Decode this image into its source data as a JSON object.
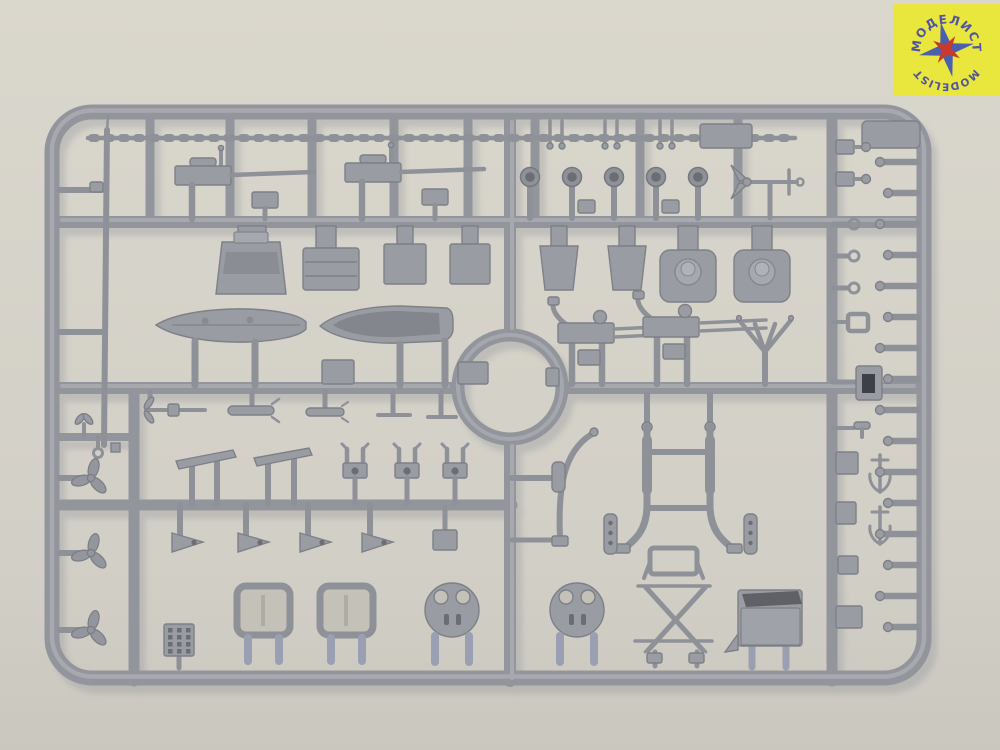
{
  "scene": {
    "description": "Photograph of a grey injection-moulded plastic model-kit sprue (parts runner) with naval ship fittings, lying on a light warm-grey background",
    "colors": {
      "background_top": "#dad7cd",
      "background_bottom": "#cac7bf",
      "plastic_base": "#93959c",
      "plastic_highlight": "#b2b4ba",
      "plastic_shadow": "#7e8087",
      "plastic_blue_tint": "#9aa0b2",
      "recess_dark": "#6b6d73"
    }
  },
  "logo": {
    "text_top": "МОДЕЛИСТ",
    "text_bottom": "MODELIST",
    "colors": {
      "background": "#e9e63d",
      "text": "#5054a4",
      "star_outer": "#4a5fae",
      "star_inner": "#c8392f"
    }
  },
  "sprue": {
    "parts": [
      {
        "label": "signal mast pole",
        "count": 1
      },
      {
        "label": "deck railing strip",
        "count": 1
      },
      {
        "label": "deck gun",
        "count": 2
      },
      {
        "label": "mooring bollard pair",
        "count": 3
      },
      {
        "label": "equipment block",
        "count": 1
      },
      {
        "label": "searchlight",
        "count": 5
      },
      {
        "label": "stocked anchor",
        "count": 1
      },
      {
        "label": "gun house",
        "count": 1
      },
      {
        "label": "stowage box",
        "count": 1
      },
      {
        "label": "deck cabin",
        "count": 2
      },
      {
        "label": "hopper box",
        "count": 2
      },
      {
        "label": "turret base with barbette",
        "count": 2
      },
      {
        "label": "ship's boat with deck",
        "count": 1
      },
      {
        "label": "open ship's boat",
        "count": 1
      },
      {
        "label": "small deckhouse",
        "count": 2
      },
      {
        "label": "circular runner ring",
        "count": 1
      },
      {
        "label": "twin anti-aircraft gun",
        "count": 2
      },
      {
        "label": "boat cradle",
        "count": 1
      },
      {
        "label": "propeller shaft",
        "count": 1
      },
      {
        "label": "torpedo",
        "count": 2
      },
      {
        "label": "tee fitting",
        "count": 2
      },
      {
        "label": "rudder plate",
        "count": 2
      },
      {
        "label": "davit head block",
        "count": 3
      },
      {
        "label": "gusset plate",
        "count": 4
      },
      {
        "label": "fitting box",
        "count": 1
      },
      {
        "label": "curved boat davit",
        "count": 1
      },
      {
        "label": "davit frame",
        "count": 1
      },
      {
        "label": "boarding ladder",
        "count": 2
      },
      {
        "label": "accommodation ladder",
        "count": 1
      },
      {
        "label": "hatch frame",
        "count": 2
      },
      {
        "label": "gun tub platform",
        "count": 2
      },
      {
        "label": "bridge box",
        "count": 1
      },
      {
        "label": "grating block",
        "count": 1
      },
      {
        "label": "propeller",
        "count": 3
      },
      {
        "label": "small anchor",
        "count": 2
      },
      {
        "label": "railing stanchion",
        "count": 16
      },
      {
        "label": "eyebolt",
        "count": 3
      },
      {
        "label": "bollard fitting",
        "count": 2
      },
      {
        "label": "square frame fitting",
        "count": 1
      },
      {
        "label": "chock with opening",
        "count": 1
      },
      {
        "label": "cleat",
        "count": 1
      },
      {
        "label": "deck fitting box",
        "count": 4
      },
      {
        "label": "flat plate",
        "count": 1
      },
      {
        "label": "left rail small fittings",
        "count": 1
      }
    ]
  }
}
